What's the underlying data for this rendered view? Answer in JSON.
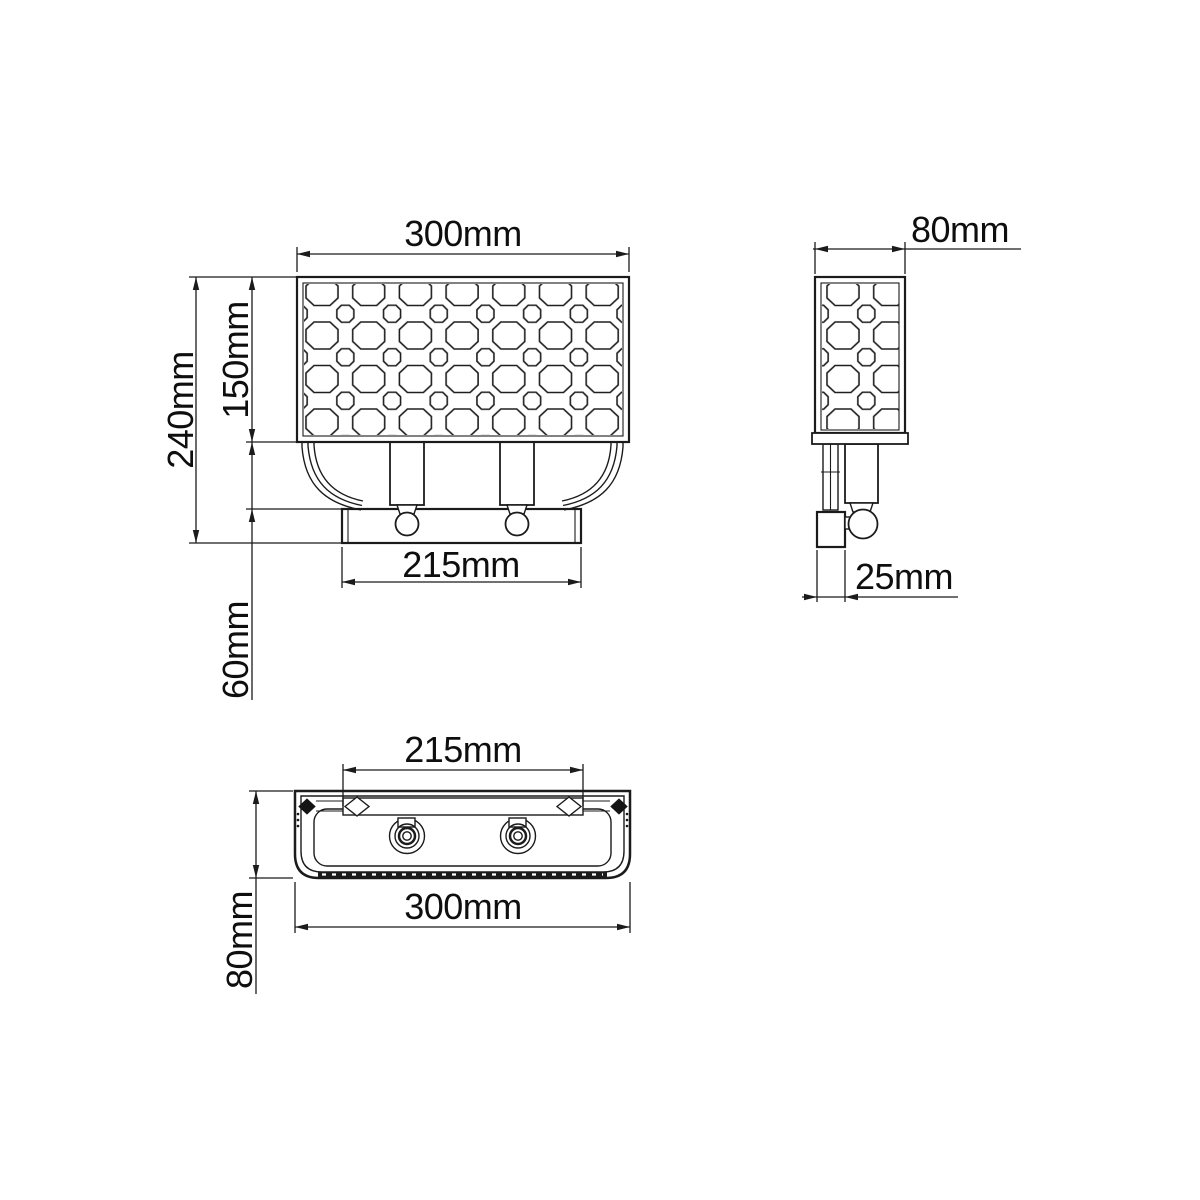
{
  "background_color": "#ffffff",
  "line_color": "#1b1b1b",
  "unit": "mm",
  "views": {
    "front": {
      "width_label": "300mm",
      "total_height_label": "240mm",
      "shade_height_label": "150mm",
      "arm_height_label": "60mm",
      "backplate_width_label": "215mm",
      "width_value": 300,
      "total_height_value": 240,
      "shade_height_value": 150,
      "arm_height_value": 60,
      "backplate_width_value": 215
    },
    "side": {
      "depth_label": "80mm",
      "wall_box_depth_label": "25mm",
      "depth_value": 80,
      "wall_box_depth_value": 25
    },
    "bottom": {
      "mount_bar_width_label": "215mm",
      "width_label": "300mm",
      "depth_label": "80mm",
      "mount_bar_width_value": 215,
      "width_value": 300,
      "depth_value": 80
    }
  }
}
